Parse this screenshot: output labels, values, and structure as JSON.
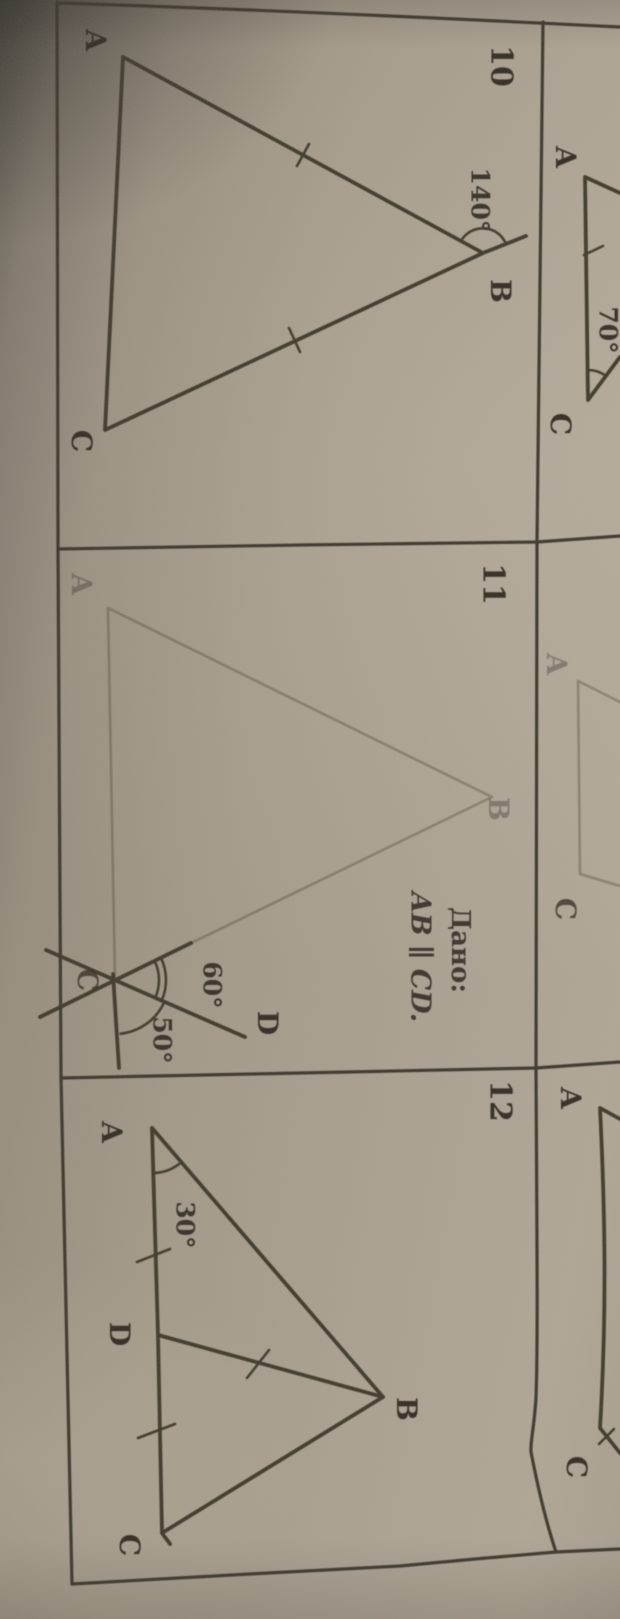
{
  "colors": {
    "paper_light": "#b1a797",
    "paper_dark": "#59544b",
    "ink": "#3e372c",
    "grid_line": "#3a342b",
    "faint_ink": "rgba(78,71,58,0.40)"
  },
  "problems": [
    {
      "number": "10",
      "vertex_a": "A",
      "vertex_b": "B",
      "vertex_c": "C",
      "angle_b_label": "140°"
    },
    {
      "number": "11",
      "vertex_a": "A",
      "vertex_b": "B",
      "vertex_c": "C",
      "point_d": "D",
      "angle_upper": "60°",
      "angle_lower": "50°",
      "given_heading": "Дано:",
      "given_statement": "AB ∥ CD."
    },
    {
      "number": "12",
      "vertex_a": "A",
      "vertex_b": "B",
      "vertex_c": "C",
      "point_d": "D",
      "angle_a_label": "30°"
    }
  ],
  "right_column_partials": [
    {
      "vertex_a": "A",
      "vertex_c": "C",
      "angle_c": "70°"
    },
    {
      "vertex_a": "A",
      "vertex_c": "C"
    },
    {
      "vertex_a": "A",
      "vertex_c": "C"
    }
  ]
}
